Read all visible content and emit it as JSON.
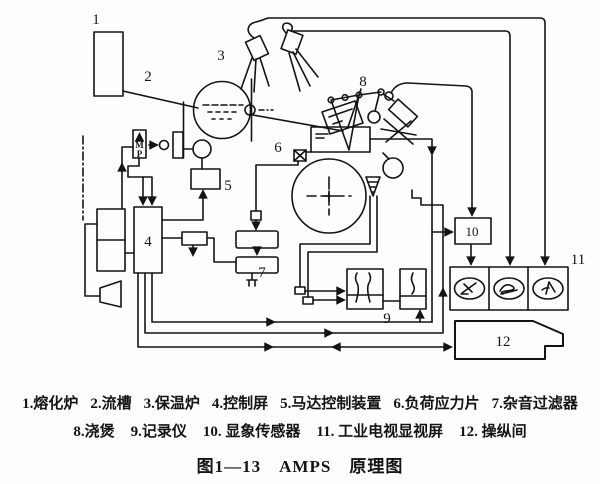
{
  "figure": {
    "caption_title": "图1—13　AMPS　原理图",
    "legend_row1": [
      "1.熔化炉",
      "2.流槽",
      "3.保温炉",
      "4.控制屏",
      "5.马达控制装置",
      "6.负荷应力片",
      "7.杂音过滤器"
    ],
    "legend_row2": [
      "8.浇煲",
      "9.记录仪",
      "10. 显象传感器",
      "11. 工业电视显视屏",
      "12. 操纵间"
    ]
  },
  "diagram": {
    "labels": {
      "n1": "1",
      "n2": "2",
      "n3": "3",
      "n4": "4",
      "n5": "5",
      "n6": "6",
      "n7": "7",
      "n8": "8",
      "n9": "9",
      "n10": "10",
      "n11": "11",
      "n12": "12"
    },
    "valve_letters": {
      "m": "M",
      "p": "P"
    },
    "colors": {
      "ink": "#141414",
      "bg": "#fdfdfd"
    }
  }
}
